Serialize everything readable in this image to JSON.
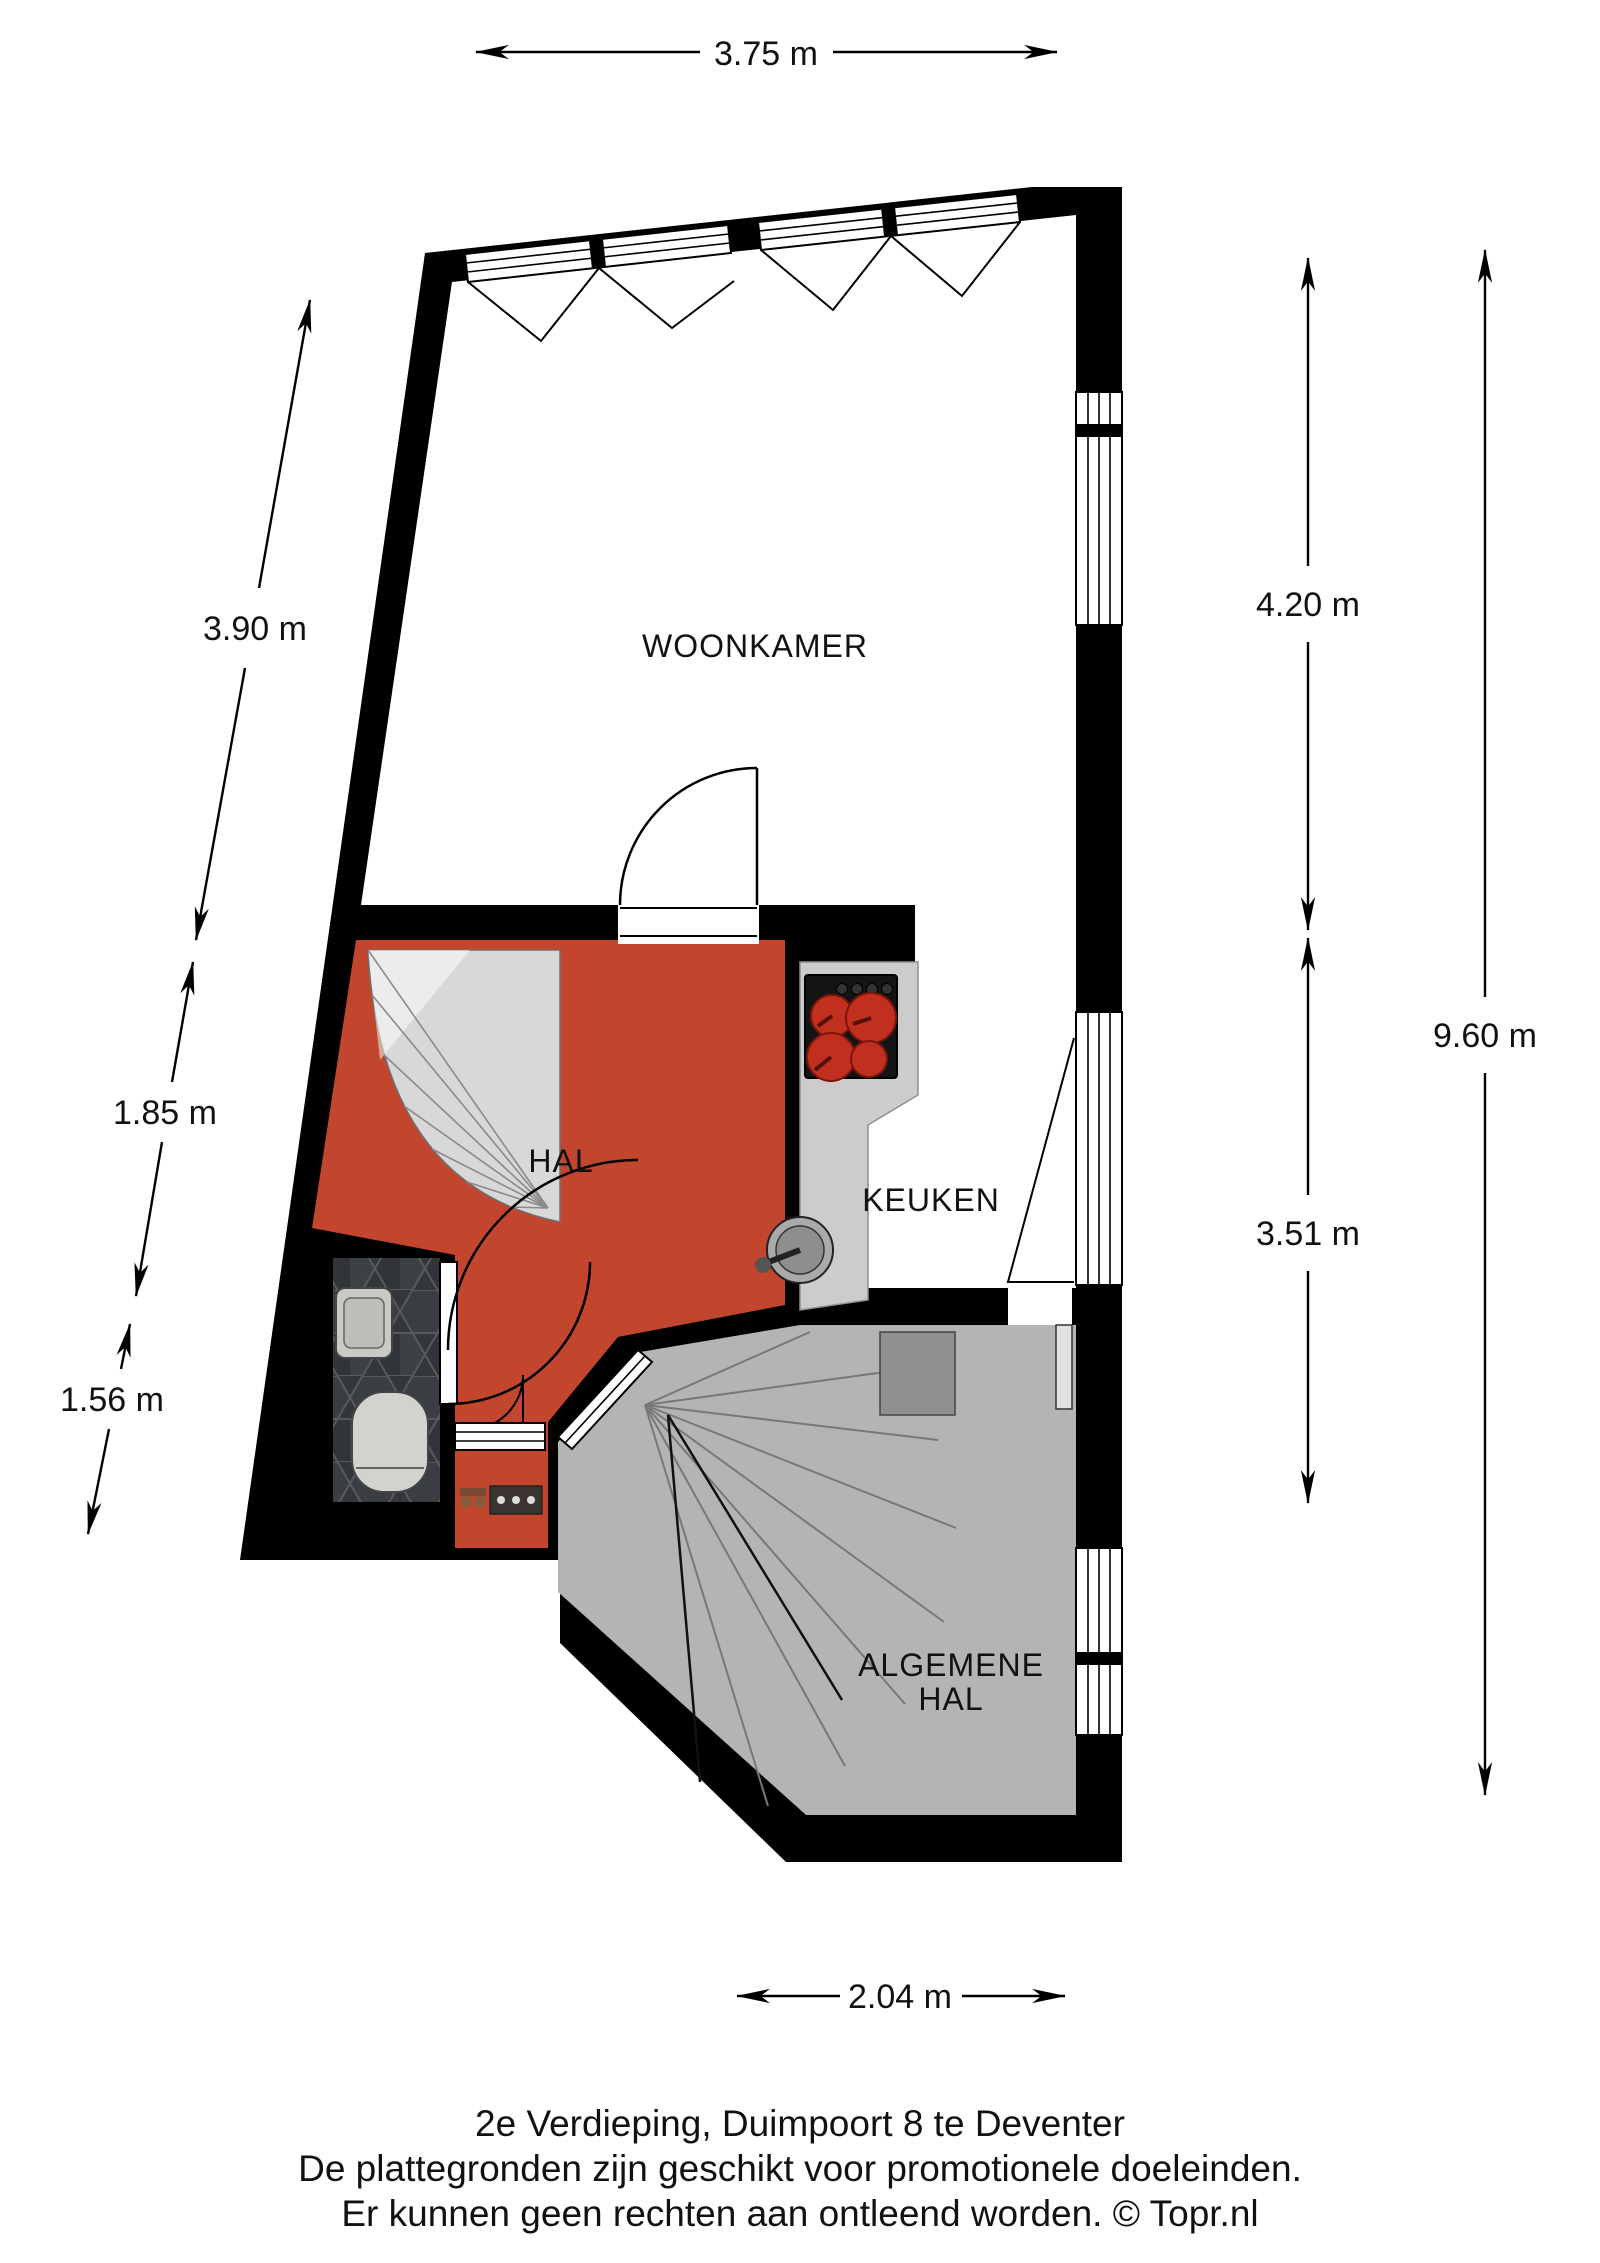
{
  "plan": {
    "rooms": {
      "woonkamer": "WOONKAMER",
      "hal": "HAL",
      "keuken": "KEUKEN",
      "algemene_hal_line1": "ALGEMENE",
      "algemene_hal_line2": "HAL"
    },
    "dimensions": {
      "top_width": "3.75 m",
      "left_upper": "3.90 m",
      "left_middle": "1.85 m",
      "left_lower": "1.56 m",
      "right_woonkamer": "4.20 m",
      "right_total": "9.60 m",
      "right_keuken": "3.51 m",
      "bottom_width": "2.04 m"
    },
    "colors": {
      "wall": "#000000",
      "hall_floor": "#c2462e",
      "common_hall_floor": "#b4b4b4",
      "stair_tread": "#d8d8d8",
      "counter": "#cccccc",
      "toilet_tile": "#34373a",
      "burner_red": "#c1301f",
      "stove_black": "#141414"
    }
  },
  "footer": {
    "line1": "2e Verdieping, Duimpoort 8 te Deventer",
    "line2": "De plattegronden zijn geschikt voor promotionele doeleinden.",
    "line3": "Er kunnen geen rechten aan ontleend worden. © Topr.nl"
  }
}
